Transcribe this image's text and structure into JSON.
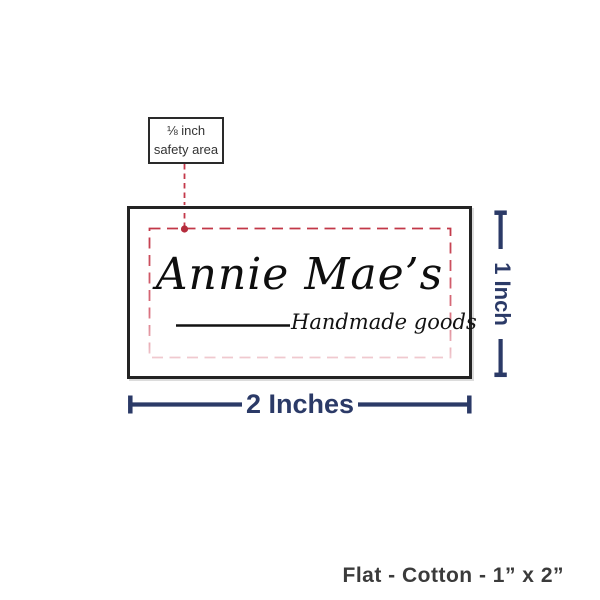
{
  "diagram": {
    "callout": {
      "line1": "⅛ inch",
      "line2": "safety area"
    },
    "label": {
      "brand": "Annie Mae’s",
      "tagline": "Handmade goods"
    },
    "dimensions": {
      "width": "2 Inches",
      "height": "1 Inch"
    },
    "caption": "Flat - Cotton - 1” x 2”",
    "colors": {
      "dimension_navy": "#2b3a67",
      "safety_red": "#c23848",
      "safety_red_fade": "#f0c9cf",
      "anchor_dot_red": "#b52c3c",
      "label_border": "#232323",
      "caption_gray": "#3b3b3b"
    }
  }
}
